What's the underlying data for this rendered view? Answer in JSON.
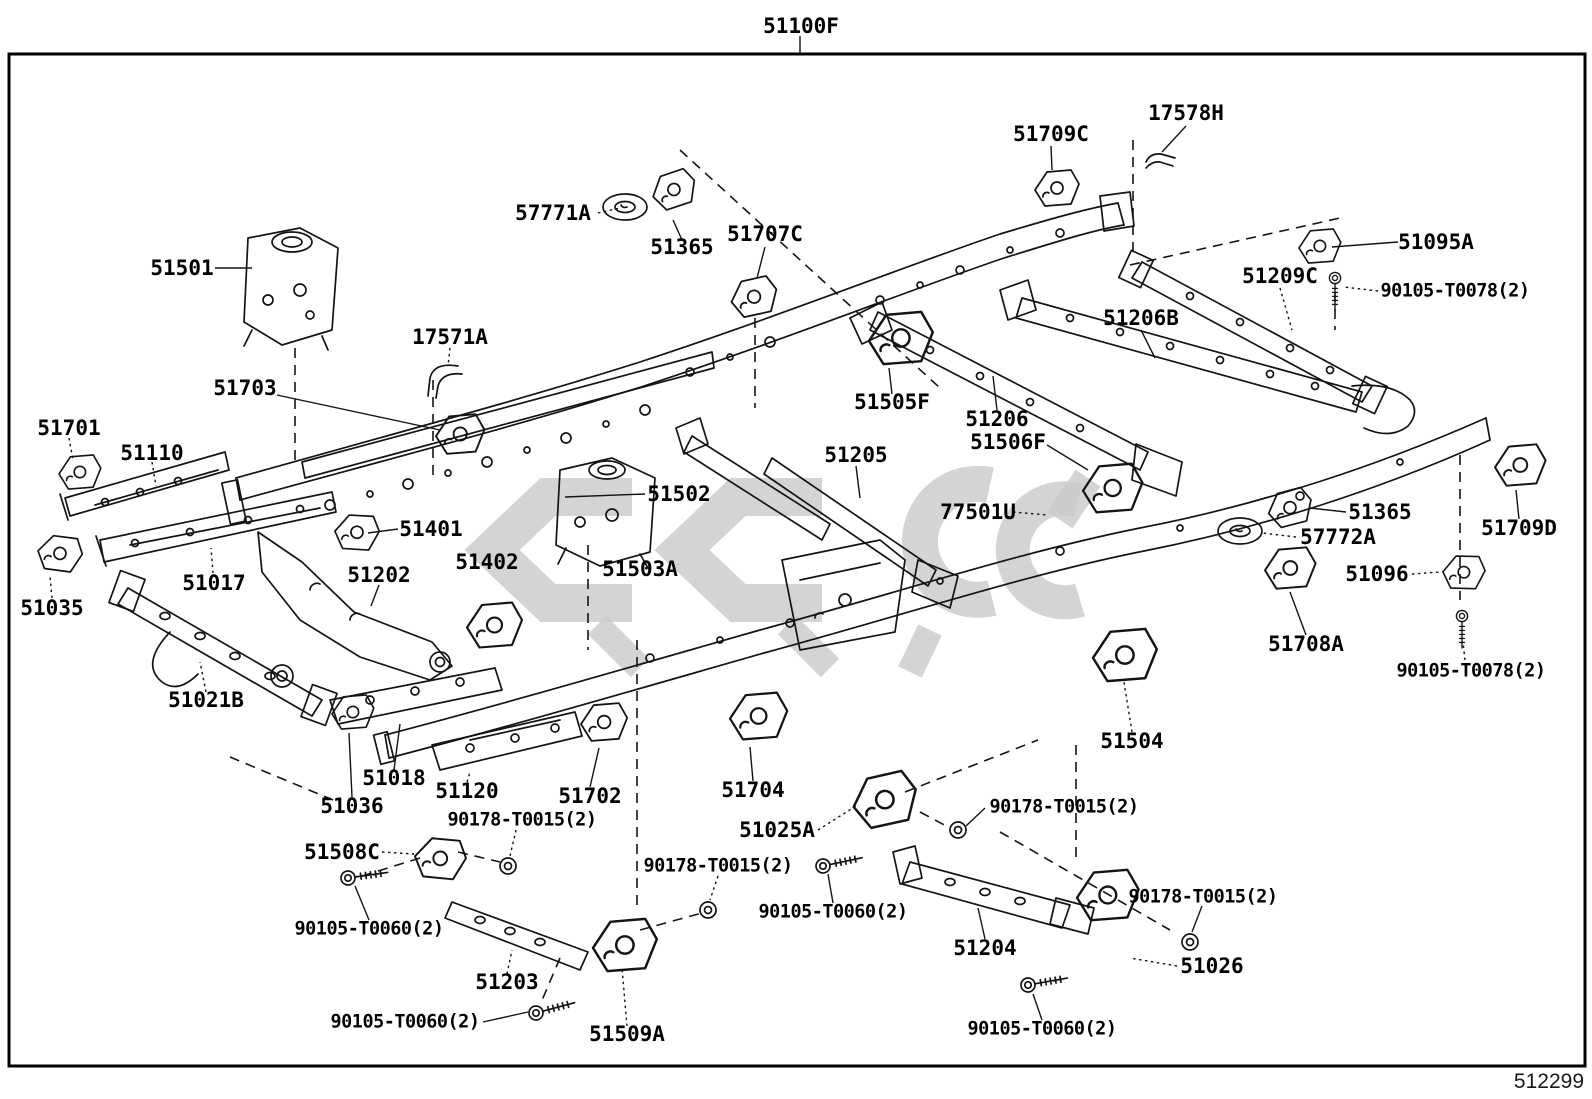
{
  "diagram": {
    "title_code": "51100F",
    "sheet_number": "512299",
    "labels": [
      {
        "text": "51100F",
        "x": 801,
        "y": 26
      },
      {
        "text": "51709C",
        "x": 1051,
        "y": 134
      },
      {
        "text": "17578H",
        "x": 1186,
        "y": 113
      },
      {
        "text": "57771A",
        "x": 553,
        "y": 213
      },
      {
        "text": "51365",
        "x": 682,
        "y": 247
      },
      {
        "text": "51707C",
        "x": 765,
        "y": 234
      },
      {
        "text": "51095A",
        "x": 1436,
        "y": 242
      },
      {
        "text": "51209C",
        "x": 1280,
        "y": 276
      },
      {
        "text": "90105-T0078(2)",
        "x": 1455,
        "y": 291,
        "small": true
      },
      {
        "text": "51206B",
        "x": 1141,
        "y": 318
      },
      {
        "text": "51501",
        "x": 182,
        "y": 268
      },
      {
        "text": "17571A",
        "x": 450,
        "y": 337
      },
      {
        "text": "51703",
        "x": 245,
        "y": 388
      },
      {
        "text": "51110",
        "x": 152,
        "y": 453
      },
      {
        "text": "51701",
        "x": 69,
        "y": 428
      },
      {
        "text": "51505F",
        "x": 892,
        "y": 402
      },
      {
        "text": "51206",
        "x": 997,
        "y": 419
      },
      {
        "text": "51506F",
        "x": 1008,
        "y": 442
      },
      {
        "text": "51205",
        "x": 856,
        "y": 455
      },
      {
        "text": "51502",
        "x": 679,
        "y": 494
      },
      {
        "text": "51401",
        "x": 431,
        "y": 529
      },
      {
        "text": "51402",
        "x": 487,
        "y": 562
      },
      {
        "text": "51503A",
        "x": 640,
        "y": 569
      },
      {
        "text": "77501U",
        "x": 978,
        "y": 512
      },
      {
        "text": "51017",
        "x": 214,
        "y": 583
      },
      {
        "text": "51035",
        "x": 52,
        "y": 608
      },
      {
        "text": "51202",
        "x": 379,
        "y": 575
      },
      {
        "text": "51021B",
        "x": 206,
        "y": 700
      },
      {
        "text": "51365",
        "x": 1380,
        "y": 512
      },
      {
        "text": "57772A",
        "x": 1338,
        "y": 537
      },
      {
        "text": "51096",
        "x": 1377,
        "y": 574
      },
      {
        "text": "51709D",
        "x": 1519,
        "y": 528
      },
      {
        "text": "51708A",
        "x": 1306,
        "y": 644
      },
      {
        "text": "90105-T0078(2)",
        "x": 1471,
        "y": 671,
        "small": true
      },
      {
        "text": "51504",
        "x": 1132,
        "y": 741
      },
      {
        "text": "51018",
        "x": 394,
        "y": 778
      },
      {
        "text": "51036",
        "x": 352,
        "y": 806
      },
      {
        "text": "51120",
        "x": 467,
        "y": 791
      },
      {
        "text": "51702",
        "x": 590,
        "y": 796
      },
      {
        "text": "51704",
        "x": 753,
        "y": 790
      },
      {
        "text": "90178-T0015(2)",
        "x": 522,
        "y": 820,
        "small": true
      },
      {
        "text": "51508C",
        "x": 342,
        "y": 852
      },
      {
        "text": "51025A",
        "x": 777,
        "y": 830
      },
      {
        "text": "90178-T0015(2)",
        "x": 1064,
        "y": 807,
        "small": true
      },
      {
        "text": "90178-T0015(2)",
        "x": 718,
        "y": 866,
        "small": true
      },
      {
        "text": "90105-T0060(2)",
        "x": 369,
        "y": 929,
        "small": true
      },
      {
        "text": "90105-T0060(2)",
        "x": 833,
        "y": 912,
        "small": true
      },
      {
        "text": "90178-T0015(2)",
        "x": 1203,
        "y": 897,
        "small": true
      },
      {
        "text": "51204",
        "x": 985,
        "y": 948
      },
      {
        "text": "51026",
        "x": 1212,
        "y": 966
      },
      {
        "text": "90105-T0060(2)",
        "x": 405,
        "y": 1022,
        "small": true
      },
      {
        "text": "51509A",
        "x": 627,
        "y": 1034
      },
      {
        "text": "90105-T0060(2)",
        "x": 1042,
        "y": 1029,
        "small": true
      },
      {
        "text": "51203",
        "x": 507,
        "y": 982
      }
    ]
  }
}
